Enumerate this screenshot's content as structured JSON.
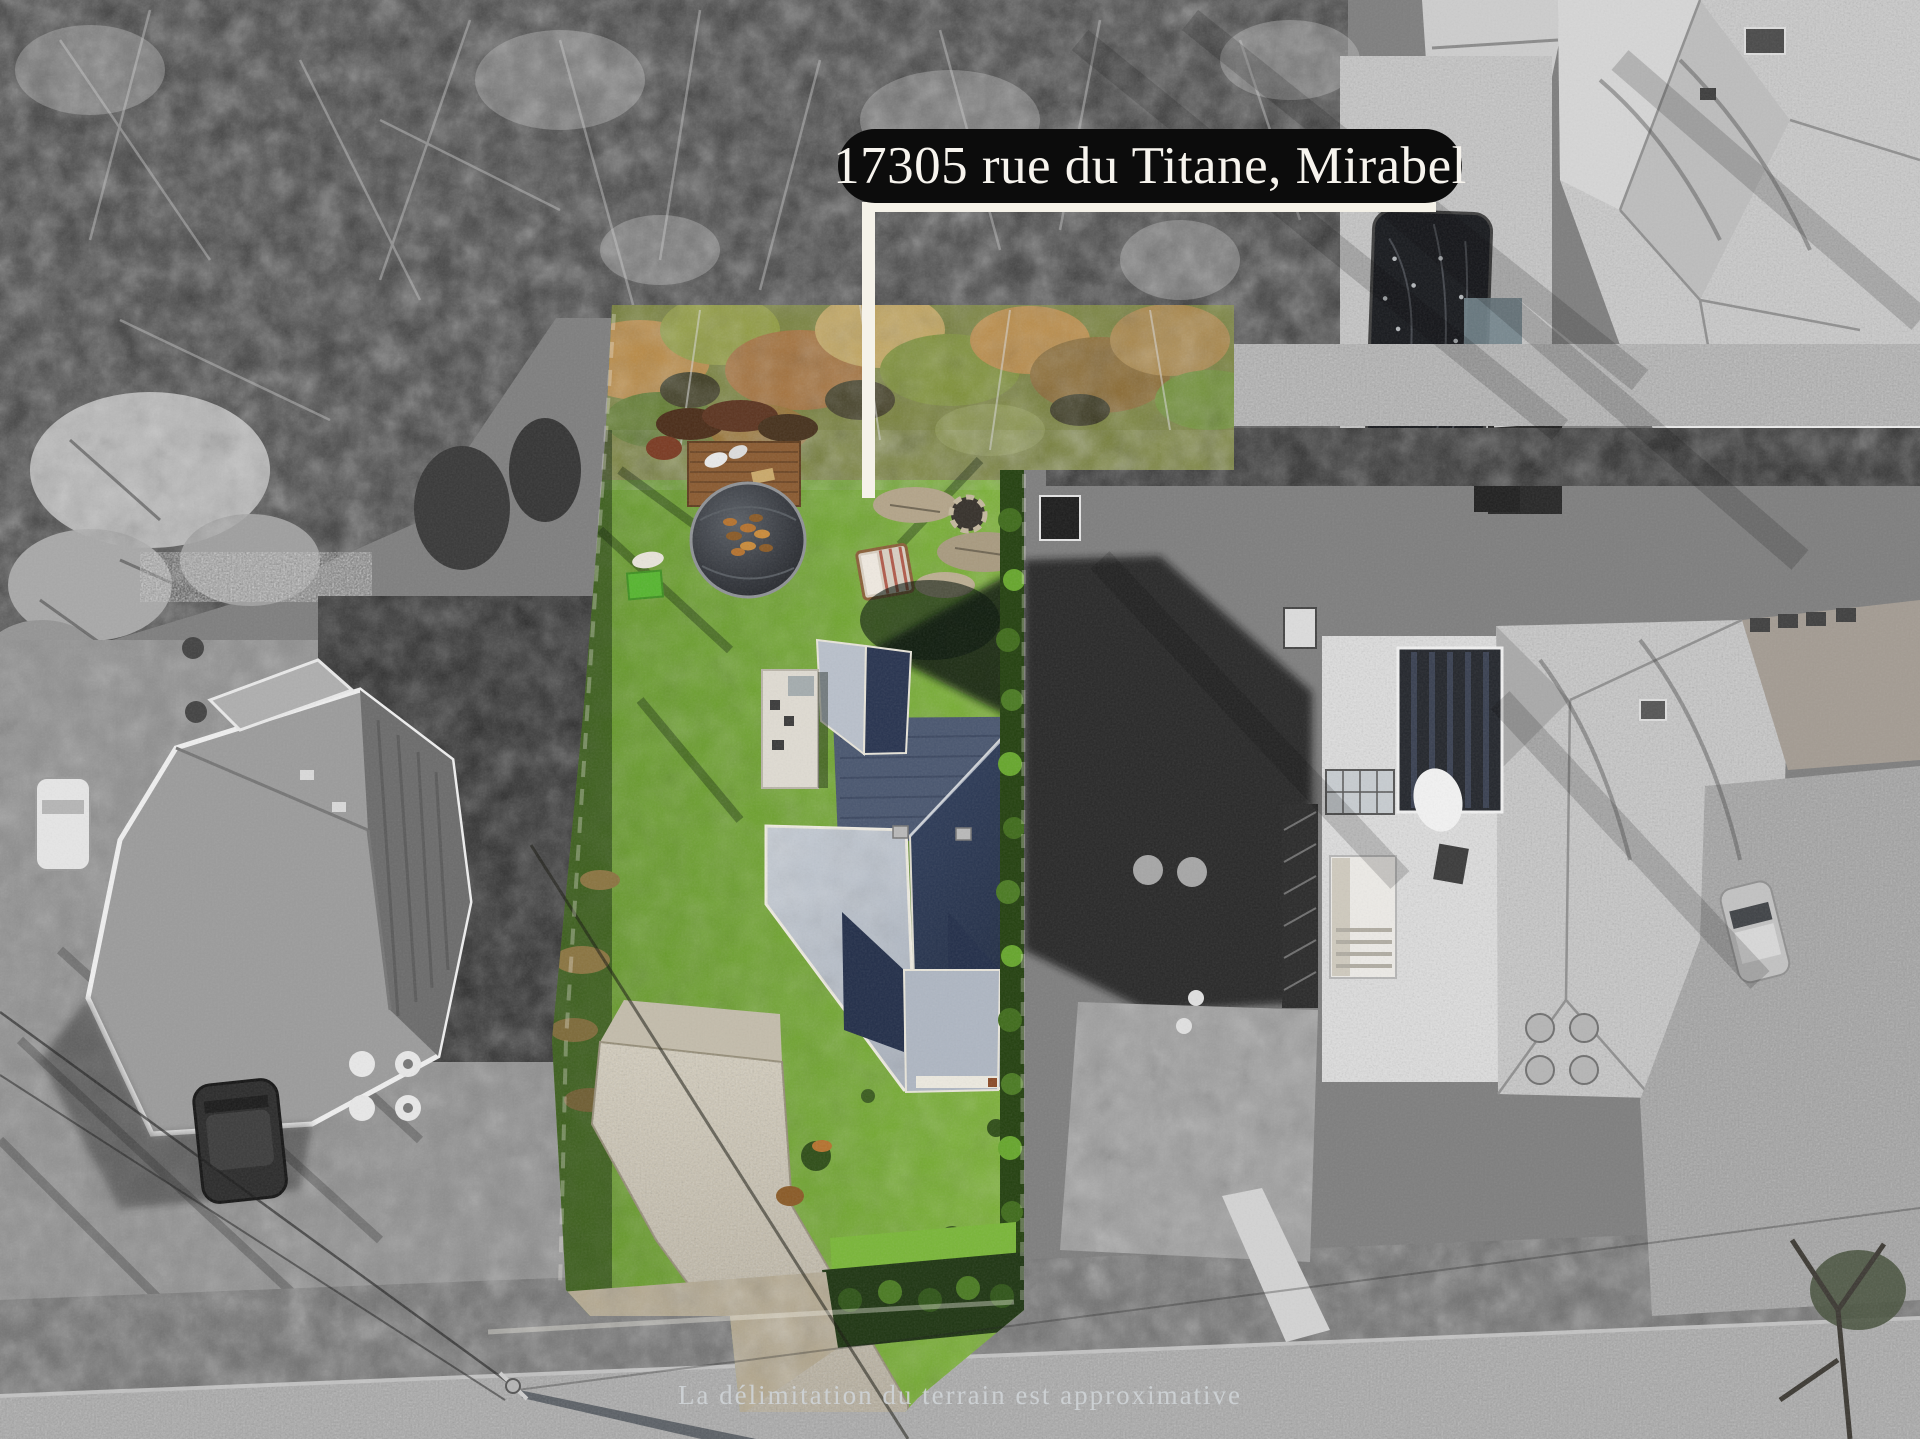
{
  "scene": {
    "description": "aerial drone photo of a residential lot; subject property in colour, surroundings desaturated"
  },
  "address_pill": {
    "text": "17305 rue du Titane, Mirabel",
    "bg_color": "#0c0c0c",
    "text_color": "#f7f4ee"
  },
  "disclaimer": {
    "text": "La délimitation du terrain est approximative",
    "text_color": "#ced2d6"
  },
  "boundary": {
    "color": "#f5f2e9"
  },
  "palette": {
    "lawn_green": "#7db239",
    "autumn_orange": "#b98a45",
    "roof_navy": "#27334f",
    "roof_light": "#b7bec9",
    "photo_gray": "#7b7b7b"
  }
}
